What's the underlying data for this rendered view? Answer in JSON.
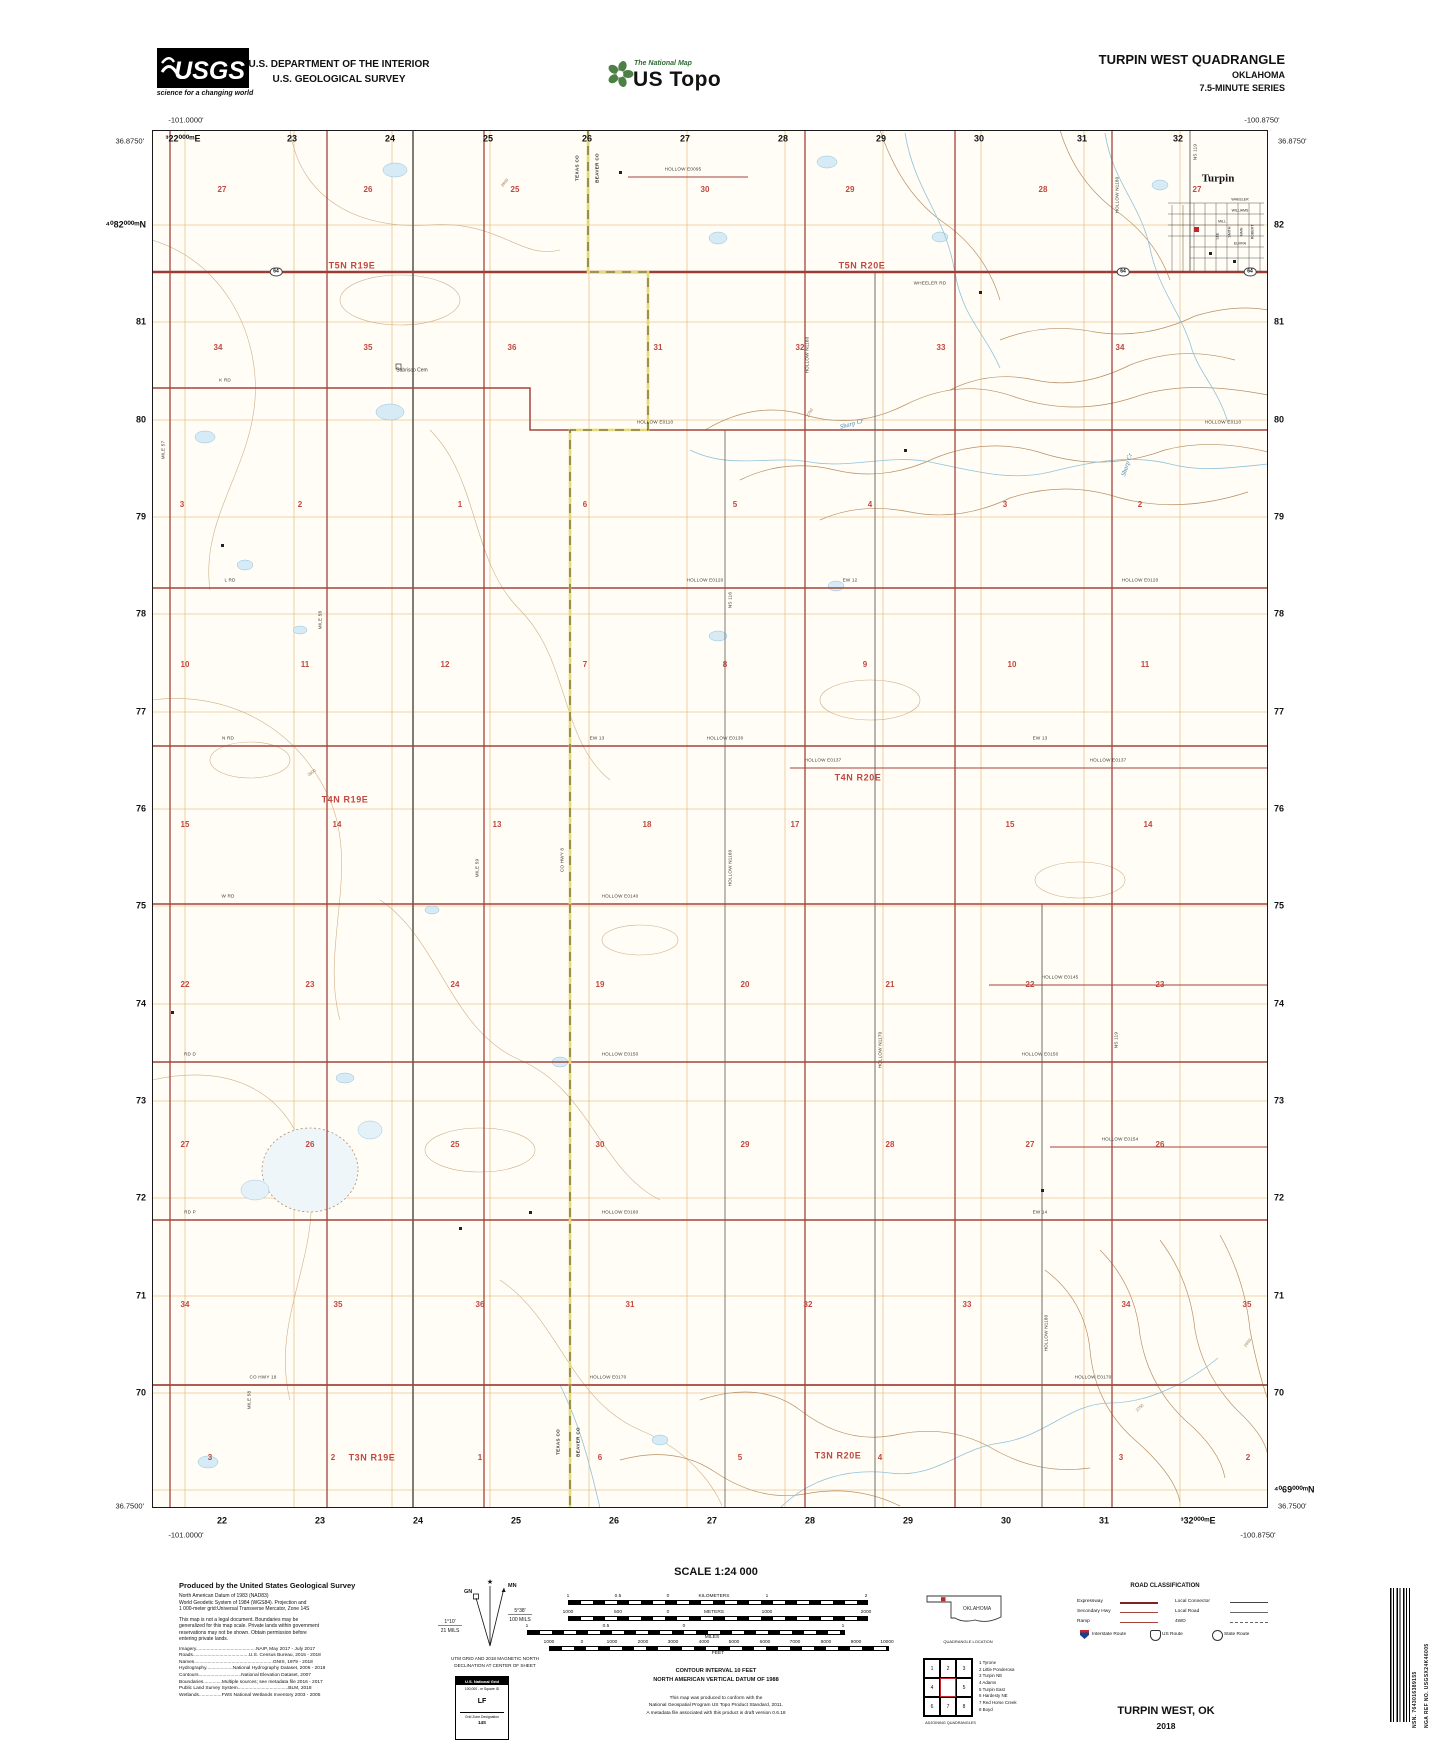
{
  "header": {
    "usgs": "USGS",
    "usgs_tagline": "science for a changing world",
    "dept_line1": "U.S. DEPARTMENT OF THE INTERIOR",
    "dept_line2": "U.S. GEOLOGICAL SURVEY",
    "tnm_brand": "The National Map",
    "tnm_name": "US Topo",
    "quad_title": "TURPIN WEST QUADRANGLE",
    "state": "OKLAHOMA",
    "series": "7.5-MINUTE SERIES"
  },
  "map": {
    "corners": {
      "tl_lon": "-101.0000'",
      "tl_lat": "36.8750'",
      "tr_lon": "-100.8750'",
      "tr_lat": "36.8750'",
      "bl_lon": "-101.0000'",
      "bl_lat": "36.7500'",
      "br_lon": "-100.8750'",
      "br_lat": "36.7500'"
    },
    "edges": {
      "top": [
        [
          "³22⁰⁰⁰ᵐE",
          183
        ],
        [
          "23",
          292
        ],
        [
          "24",
          390
        ],
        [
          "25",
          488
        ],
        [
          "26",
          587
        ],
        [
          "27",
          685
        ],
        [
          "28",
          783
        ],
        [
          "29",
          881
        ],
        [
          "30",
          979
        ],
        [
          "31",
          1082
        ],
        [
          "32",
          1178
        ]
      ],
      "bottom": [
        [
          "22",
          222
        ],
        [
          "23",
          320
        ],
        [
          "24",
          418
        ],
        [
          "25",
          516
        ],
        [
          "26",
          614
        ],
        [
          "27",
          712
        ],
        [
          "28",
          810
        ],
        [
          "29",
          908
        ],
        [
          "30",
          1006
        ],
        [
          "31",
          1104
        ],
        [
          "³32⁰⁰⁰ᵐE",
          1198
        ]
      ],
      "left": [
        [
          "⁴⁰82⁰⁰⁰ᵐN",
          225
        ],
        [
          "81",
          322
        ],
        [
          "80",
          420
        ],
        [
          "79",
          517
        ],
        [
          "78",
          614
        ],
        [
          "77",
          712
        ],
        [
          "76",
          809
        ],
        [
          "75",
          906
        ],
        [
          "74",
          1004
        ],
        [
          "73",
          1101
        ],
        [
          "72",
          1198
        ],
        [
          "71",
          1296
        ],
        [
          "70",
          1393
        ]
      ],
      "right": [
        [
          "82",
          225
        ],
        [
          "81",
          322
        ],
        [
          "80",
          420
        ],
        [
          "79",
          517
        ],
        [
          "78",
          614
        ],
        [
          "77",
          712
        ],
        [
          "76",
          809
        ],
        [
          "75",
          906
        ],
        [
          "74",
          1004
        ],
        [
          "73",
          1101
        ],
        [
          "72",
          1198
        ],
        [
          "71",
          1296
        ],
        [
          "70",
          1393
        ],
        [
          "⁴⁰69⁰⁰⁰ᵐN",
          1490
        ]
      ]
    },
    "townships": [
      [
        "T5N R19E",
        352,
        266
      ],
      [
        "T5N R20E",
        862,
        266
      ],
      [
        "T4N R19E",
        345,
        800
      ],
      [
        "T4N R20E",
        858,
        778
      ],
      [
        "T3N R19E",
        372,
        1458
      ],
      [
        "T3N R20E",
        838,
        1456
      ]
    ],
    "sections": [
      {
        "y": 190,
        "c": [
          [
            222,
            "27"
          ],
          [
            368,
            "26"
          ],
          [
            515,
            "25"
          ],
          [
            705,
            "30"
          ],
          [
            850,
            "29"
          ],
          [
            1043,
            "28"
          ],
          [
            1197,
            "27"
          ]
        ]
      },
      {
        "y": 348,
        "c": [
          [
            218,
            "34"
          ],
          [
            368,
            "35"
          ],
          [
            512,
            "36"
          ],
          [
            658,
            "31"
          ],
          [
            800,
            "32"
          ],
          [
            941,
            "33"
          ],
          [
            1120,
            "34"
          ]
        ]
      },
      {
        "y": 505,
        "c": [
          [
            182,
            "3"
          ],
          [
            300,
            "2"
          ],
          [
            460,
            "1"
          ],
          [
            585,
            "6"
          ],
          [
            735,
            "5"
          ],
          [
            870,
            "4"
          ],
          [
            1005,
            "3"
          ],
          [
            1140,
            "2"
          ]
        ]
      },
      {
        "y": 665,
        "c": [
          [
            185,
            "10"
          ],
          [
            305,
            "11"
          ],
          [
            445,
            "12"
          ],
          [
            585,
            "7"
          ],
          [
            725,
            "8"
          ],
          [
            865,
            "9"
          ],
          [
            1012,
            "10"
          ],
          [
            1145,
            "11"
          ]
        ]
      },
      {
        "y": 825,
        "c": [
          [
            185,
            "15"
          ],
          [
            337,
            "14"
          ],
          [
            497,
            "13"
          ],
          [
            647,
            "18"
          ],
          [
            795,
            "17"
          ],
          [
            1010,
            "15"
          ],
          [
            1148,
            "14"
          ]
        ]
      },
      {
        "y": 985,
        "c": [
          [
            185,
            "22"
          ],
          [
            310,
            "23"
          ],
          [
            455,
            "24"
          ],
          [
            600,
            "19"
          ],
          [
            745,
            "20"
          ],
          [
            890,
            "21"
          ],
          [
            1030,
            "22"
          ],
          [
            1160,
            "23"
          ]
        ]
      },
      {
        "y": 1145,
        "c": [
          [
            185,
            "27"
          ],
          [
            310,
            "26"
          ],
          [
            455,
            "25"
          ],
          [
            600,
            "30"
          ],
          [
            745,
            "29"
          ],
          [
            890,
            "28"
          ],
          [
            1030,
            "27"
          ],
          [
            1160,
            "26"
          ]
        ]
      },
      {
        "y": 1305,
        "c": [
          [
            185,
            "34"
          ],
          [
            338,
            "35"
          ],
          [
            480,
            "36"
          ],
          [
            630,
            "31"
          ],
          [
            808,
            "32"
          ],
          [
            967,
            "33"
          ],
          [
            1126,
            "34"
          ],
          [
            1247,
            "35"
          ]
        ]
      },
      {
        "y": 1458,
        "c": [
          [
            210,
            "3"
          ],
          [
            333,
            "2"
          ],
          [
            480,
            "1"
          ],
          [
            600,
            "6"
          ],
          [
            740,
            "5"
          ],
          [
            880,
            "4"
          ],
          [
            1121,
            "3"
          ],
          [
            1248,
            "2"
          ]
        ]
      }
    ],
    "roads_h": [
      [
        683,
        170,
        "HOLLOW E0095"
      ],
      [
        225,
        381,
        "K RD"
      ],
      [
        655,
        423,
        "HOLLOW E0110"
      ],
      [
        1223,
        423,
        "HOLLOW E0110"
      ],
      [
        230,
        581,
        "L RD"
      ],
      [
        705,
        581,
        "HOLLOW E0120"
      ],
      [
        850,
        581,
        "EW 12"
      ],
      [
        1140,
        581,
        "HOLLOW E0120"
      ],
      [
        228,
        739,
        "N RD"
      ],
      [
        597,
        739,
        "EW 13"
      ],
      [
        725,
        739,
        "HOLLOW E0130"
      ],
      [
        1040,
        739,
        "EW 13"
      ],
      [
        823,
        761,
        "HOLLOW E0137"
      ],
      [
        1108,
        761,
        "HOLLOW E0137"
      ],
      [
        228,
        897,
        "W RD"
      ],
      [
        620,
        897,
        "HOLLOW E0140"
      ],
      [
        1060,
        978,
        "HOLLOW E0145"
      ],
      [
        190,
        1055,
        "RD D"
      ],
      [
        620,
        1055,
        "HOLLOW E0150"
      ],
      [
        1040,
        1055,
        "HOLLOW E0150"
      ],
      [
        1120,
        1140,
        "HOLLOW E0154"
      ],
      [
        190,
        1213,
        "RD P"
      ],
      [
        620,
        1213,
        "HOLLOW E0160"
      ],
      [
        1040,
        1213,
        "EW 14"
      ],
      [
        263,
        1378,
        "CO HWY 19"
      ],
      [
        608,
        1378,
        "HOLLOW E0170"
      ],
      [
        1093,
        1378,
        "HOLLOW E0170"
      ],
      [
        930,
        284,
        "WHEELER RD"
      ]
    ],
    "roads_v": [
      [
        164,
        450,
        "MILE 57"
      ],
      [
        321,
        620,
        "MILE 58"
      ],
      [
        478,
        868,
        "MILE 59"
      ],
      [
        250,
        1400,
        "MILE 58"
      ],
      [
        563,
        860,
        "CO HWY 8"
      ],
      [
        808,
        355,
        "HOLLOW N1160"
      ],
      [
        731,
        868,
        "HOLLOW N1160"
      ],
      [
        881,
        1050,
        "HOLLOW N1170"
      ],
      [
        1118,
        195,
        "HOLLOW N1180"
      ],
      [
        1047,
        1333,
        "HOLLOW N1180"
      ],
      [
        1196,
        152,
        "NS 119"
      ],
      [
        1117,
        1040,
        "NS 119"
      ],
      [
        731,
        600,
        "NS 116"
      ]
    ],
    "water_labels": [
      [
        852,
        425,
        "Sharp Cr",
        -15
      ],
      [
        1128,
        465,
        "Sharp Cr",
        -72
      ]
    ],
    "contour_labels": [
      [
        505,
        183,
        "2800",
        -50
      ],
      [
        312,
        773,
        "2800",
        -35
      ],
      [
        810,
        413,
        "2750",
        -60
      ],
      [
        1248,
        1343,
        "2650",
        -55
      ],
      [
        1140,
        1408,
        "2750",
        -45
      ]
    ],
    "places": [
      [
        1218,
        179,
        "Turpin"
      ]
    ],
    "cemetery": {
      "x": 412,
      "y": 371,
      "label": "Sabrisco Cem"
    },
    "county_labels": [
      [
        578,
        168,
        "TEXAS CO"
      ],
      [
        598,
        168,
        "BEAVER CO"
      ],
      [
        559,
        1442,
        "TEXAS CO"
      ],
      [
        579,
        1442,
        "BEAVER CO"
      ]
    ],
    "streets": [
      [
        1240,
        200,
        "WHEELER",
        0
      ],
      [
        1240,
        211,
        "WILLIAMS",
        0
      ],
      [
        1222,
        222,
        "MILL",
        0
      ],
      [
        1240,
        244,
        "ELVIRA",
        0
      ],
      [
        1230,
        232,
        "SMITH",
        -90
      ],
      [
        1242,
        232,
        "MAIN",
        -90
      ],
      [
        1253,
        232,
        "ROBERT",
        -90
      ],
      [
        1218,
        236,
        "LEE",
        -90
      ]
    ],
    "shields": [
      [
        276,
        272,
        "64"
      ],
      [
        1123,
        272,
        "64"
      ],
      [
        1250,
        272,
        "64"
      ]
    ]
  },
  "footer": {
    "produced_title": "Produced by the United States Geological Survey",
    "datum_lines": [
      "North American Datum of 1983 (NAD83)",
      "World Geodetic System of 1984 (WGS84).  Projection and",
      "1 000-meter grid:Universal Transverse Mercator, Zone 14S"
    ],
    "legal_lines": [
      "This map is not a legal document. Boundaries may be",
      "generalized for this map scale. Private lands within government",
      "reservations may not be shown. Obtain permission before",
      "entering private lands."
    ],
    "credits": [
      "Imagery.............................................NAIP, May 2017 - July 2017",
      "Roads..........................................U.S. Census Bureau, 2015 - 2018",
      "Names...........................................................GNIS, 1979 - 2018",
      "Hydrography....................National Hydrography Dataset, 2006 - 2018",
      "Contours................................National Elevation Dataset, 2007",
      "Boundaries..............Multiple sources; see metadata file 2016 - 2017",
      "Public Land Survey System......................................BLM, 2018",
      "Wetlands.................FWS National Wetlands Inventory 2003 - 2005"
    ],
    "declination": {
      "mn": "MN",
      "gn": "GN",
      "right_deg": "5°38'",
      "right_mils": "100 MILS",
      "left_deg": "1°10'",
      "left_mils": "21 MILS",
      "cap1": "UTM GRID AND 2018 MAGNETIC NORTH",
      "cap2": "DECLINATION AT CENTER OF SHEET"
    },
    "usng": {
      "title": "U.S. National Grid",
      "sq_label": "100,000 - m Square ID",
      "square_id": "LF",
      "zone_label": "Grid Zone Designation",
      "zone": "14S"
    },
    "scale": {
      "title": "SCALE 1:24 000",
      "bars": [
        {
          "y": 1600,
          "x1": 568,
          "x2": 866,
          "labels": [
            [
              568,
              "1"
            ],
            [
              618,
              "0.5"
            ],
            [
              668,
              "0"
            ],
            [
              714,
              "KILOMETERS"
            ],
            [
              767,
              "1"
            ],
            [
              866,
              "2"
            ]
          ],
          "below": []
        },
        {
          "y": 1616,
          "x1": 568,
          "x2": 866,
          "labels": [
            [
              568,
              "1000"
            ],
            [
              618,
              "500"
            ],
            [
              668,
              "0"
            ],
            [
              714,
              "METERS"
            ],
            [
              767,
              "1000"
            ],
            [
              866,
              "2000"
            ]
          ],
          "below": []
        },
        {
          "y": 1630,
          "x1": 527,
          "x2": 843,
          "labels": [
            [
              527,
              "1"
            ],
            [
              606,
              "0.5"
            ],
            [
              684,
              "0"
            ],
            [
              843,
              "1"
            ]
          ],
          "below": [
            [
              712,
              "MILES"
            ]
          ]
        },
        {
          "y": 1646,
          "x1": 549,
          "x2": 887,
          "labels": [
            [
              549,
              "1000"
            ],
            [
              582,
              "0"
            ],
            [
              612,
              "1000"
            ],
            [
              643,
              "2000"
            ],
            [
              673,
              "3000"
            ],
            [
              704,
              "4000"
            ],
            [
              734,
              "5000"
            ],
            [
              765,
              "6000"
            ],
            [
              795,
              "7000"
            ],
            [
              826,
              "8000"
            ],
            [
              856,
              "9000"
            ],
            [
              887,
              "10000"
            ]
          ],
          "below": [
            [
              718,
              "FEET"
            ]
          ]
        }
      ]
    },
    "contour_note": "CONTOUR INTERVAL 10 FEET",
    "datum_note": "NORTH AMERICAN VERTICAL DATUM OF 1988",
    "conformance": [
      "This map was produced to conform with the",
      "National Geospatial Program US Topo Product Standard, 2011.",
      "A metadata file associated with this product is draft version 0.6.18"
    ],
    "quad_location_caption": "QUADRANGLE LOCATION",
    "quad_state": "OKLAHOMA",
    "adjoining": {
      "caption": "ADJOINING QUADRANGLES",
      "cells": [
        "1",
        "2",
        "3",
        "4",
        "",
        "5",
        "6",
        "7",
        "8"
      ],
      "list": [
        "1 Tyrone",
        "2 Little Ponderosa",
        "3 Turpin NE",
        "4 Adams",
        "5 Turpin East",
        "6 Hardesty NE",
        "7 Red Horse Creek",
        "8 Boyd"
      ]
    },
    "road_class": {
      "title": "ROAD CLASSIFICATION",
      "left": [
        [
          "Expressway",
          "exp"
        ],
        [
          "Secondary Hwy",
          "sec"
        ],
        [
          "Ramp",
          "ramp"
        ]
      ],
      "right": [
        [
          "Local Connector",
          "lc"
        ],
        [
          "Local Road",
          "lr"
        ],
        [
          "4WD",
          "fwd"
        ]
      ],
      "shields": [
        [
          "Interstate Route",
          "interstate"
        ],
        [
          "US Route",
          "us"
        ],
        [
          "State Route",
          "state"
        ]
      ]
    },
    "sheet_name": "TURPIN WEST,  OK",
    "year": "2018",
    "barcode_nsn": "NSN.  7643016389155",
    "barcode_nga": "NGA REF NO.  USGSX24K46005"
  }
}
